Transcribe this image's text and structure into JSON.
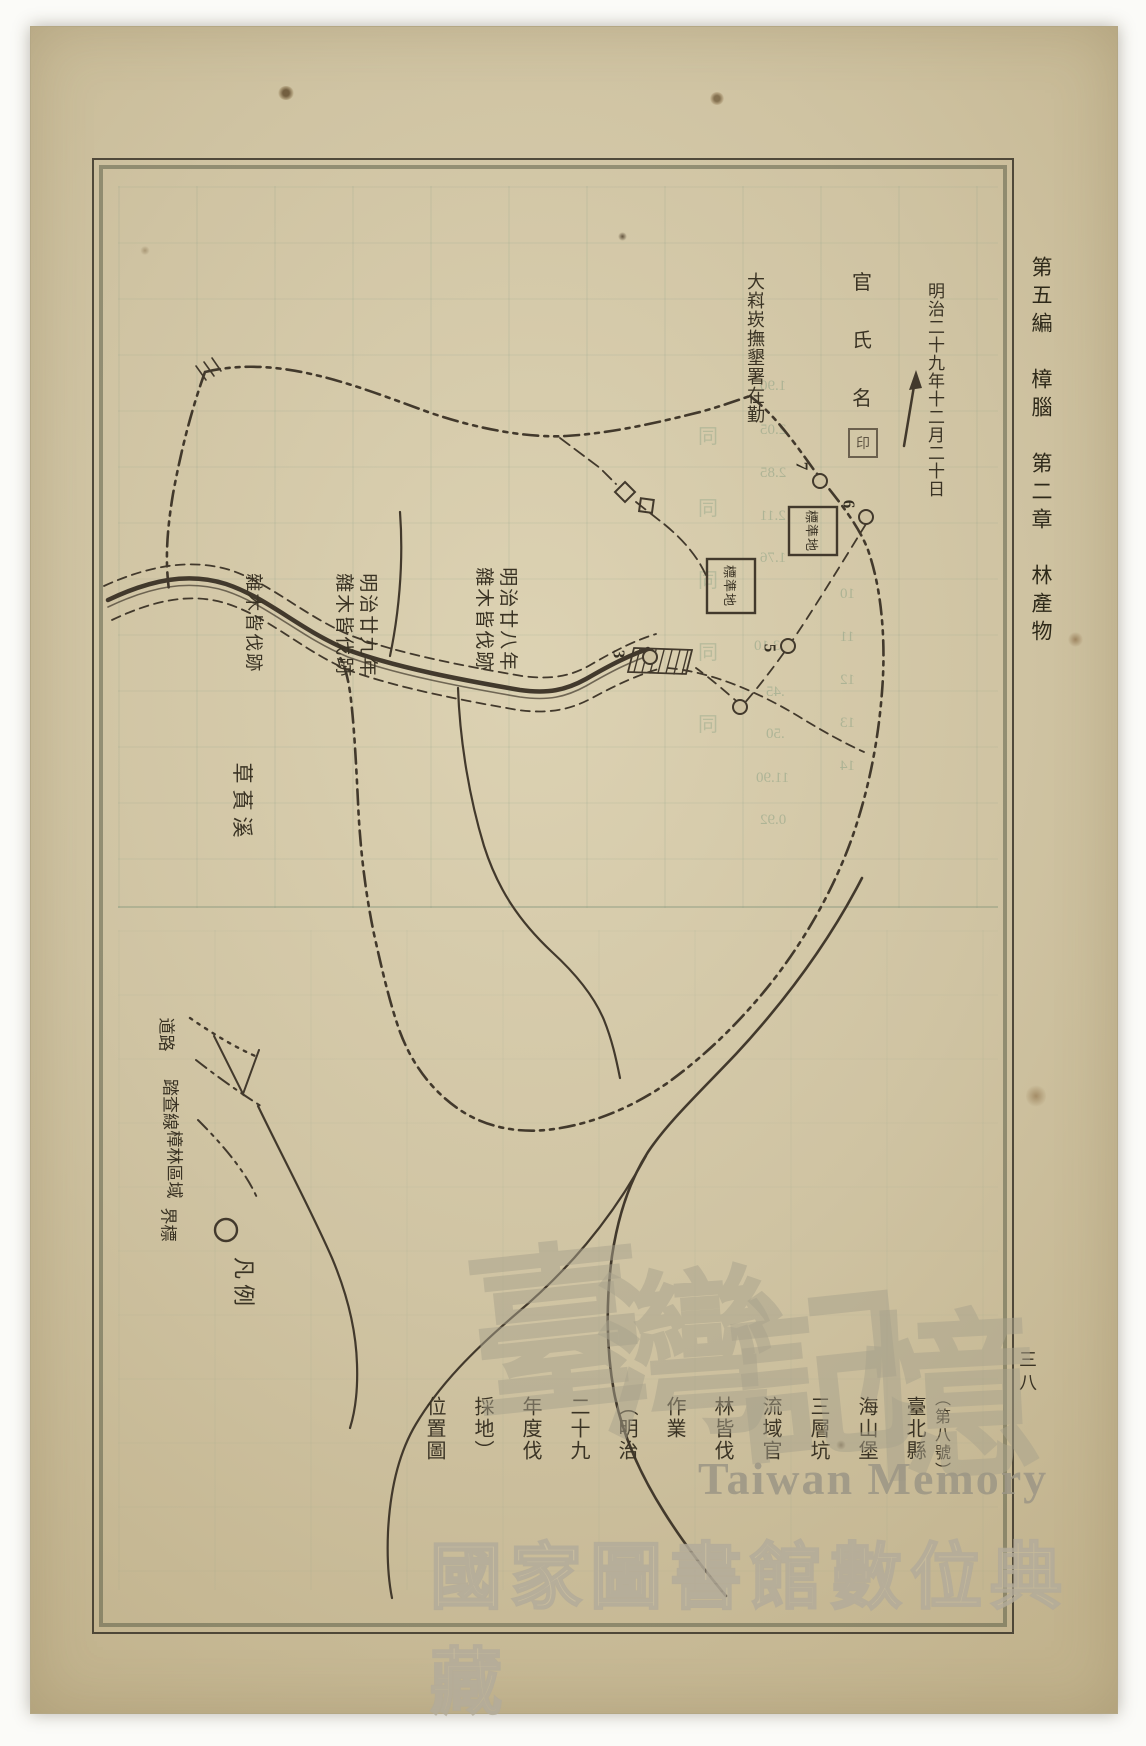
{
  "page": {
    "side_header": "第五編　樟腦　第二章　林產物",
    "page_number": "三八"
  },
  "annotations": {
    "date": "明治二十九年十二月二十日",
    "office": "大嵙崁撫墾署在勤",
    "officials": [
      "官",
      "氏",
      "名"
    ],
    "seal": "印"
  },
  "map": {
    "plot_box_label": "標準地",
    "stations": [
      "7",
      "6",
      "5",
      "3"
    ],
    "cut_sites": [
      {
        "year": "明治廿九年",
        "label": "雜木皆伐跡"
      },
      {
        "year": "明治廿八年",
        "label": "雜木皆伐跡"
      },
      {
        "year": "",
        "label": "雜木皆伐跡"
      }
    ],
    "river": "草萯溪",
    "legend": {
      "title": "凡例",
      "entries": [
        {
          "style": "dotted-line",
          "label": "道路"
        },
        {
          "style": "dash-dot-line",
          "label": "踏查線"
        },
        {
          "style": "dash-dot-dot-line",
          "label": "樟林區域"
        },
        {
          "style": "circle",
          "label": "界標"
        }
      ]
    }
  },
  "title_block": {
    "number": "（第八號）",
    "title": "臺北縣海山堡三層坑流域官林皆伐作業（明治二十九年度伐採地）位置圖"
  },
  "bleedthrough": {
    "numbers": [
      "1.90",
      "2.05",
      "2.85",
      "2.11",
      "1.76",
      "23.10",
      ".45",
      ".50",
      "11.90",
      "0.92"
    ],
    "rows": [
      "10",
      "11",
      "12",
      "13",
      "14"
    ],
    "ditto": [
      "同",
      "同",
      "同",
      "同",
      "同"
    ]
  },
  "watermark": {
    "script": [
      "臺",
      "灣",
      "記",
      "憶"
    ],
    "latin": "Taiwan Memory",
    "library": "國家圖書館數位典藏"
  },
  "colors": {
    "paper": "#cfc3a2",
    "ink": "#3e382c",
    "ghost": "#7d9484",
    "watermark": "#aaa390"
  }
}
